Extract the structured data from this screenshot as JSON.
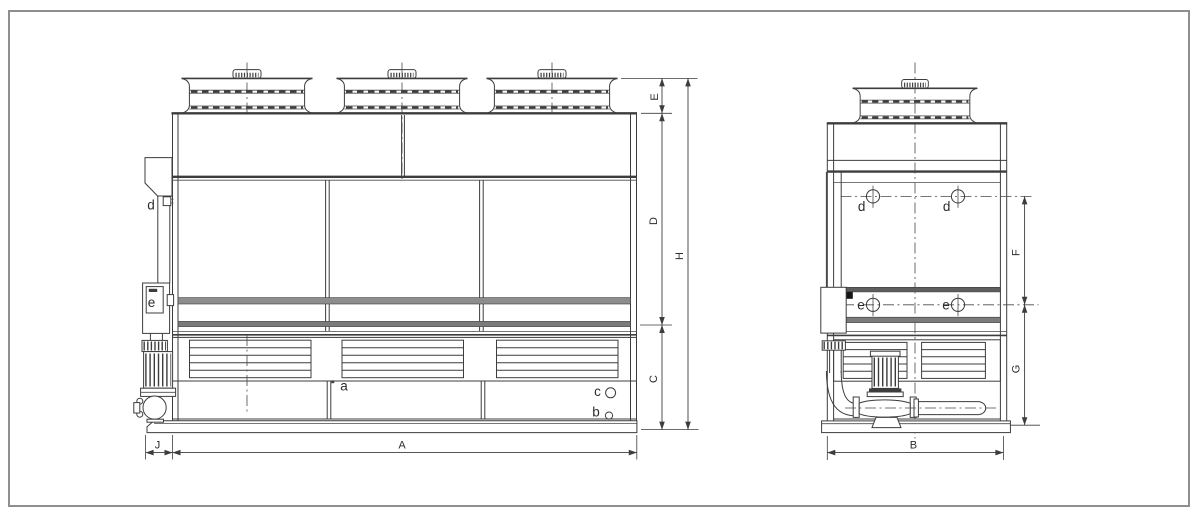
{
  "drawing_type": "cooling-tower two-view dimensional drawing",
  "front_view": {
    "dims": {
      "A": "A",
      "C": "C",
      "D": "D",
      "E": "E",
      "H": "H",
      "J": "J"
    },
    "connections": {
      "a": "a",
      "b": "b",
      "c": "c",
      "d": "d",
      "e": "e"
    }
  },
  "side_view": {
    "dims": {
      "B": "B",
      "F": "F",
      "G": "G"
    },
    "connections": {
      "d_left": "d",
      "d_right": "d",
      "e_left": "e",
      "e_right": "e"
    }
  },
  "colors": {
    "line": "#3d3d3d",
    "band_gray": "#7b7b7b",
    "band_dark": "#5e5e5e",
    "frame": "#8f8f8f",
    "background": "#ffffff"
  }
}
